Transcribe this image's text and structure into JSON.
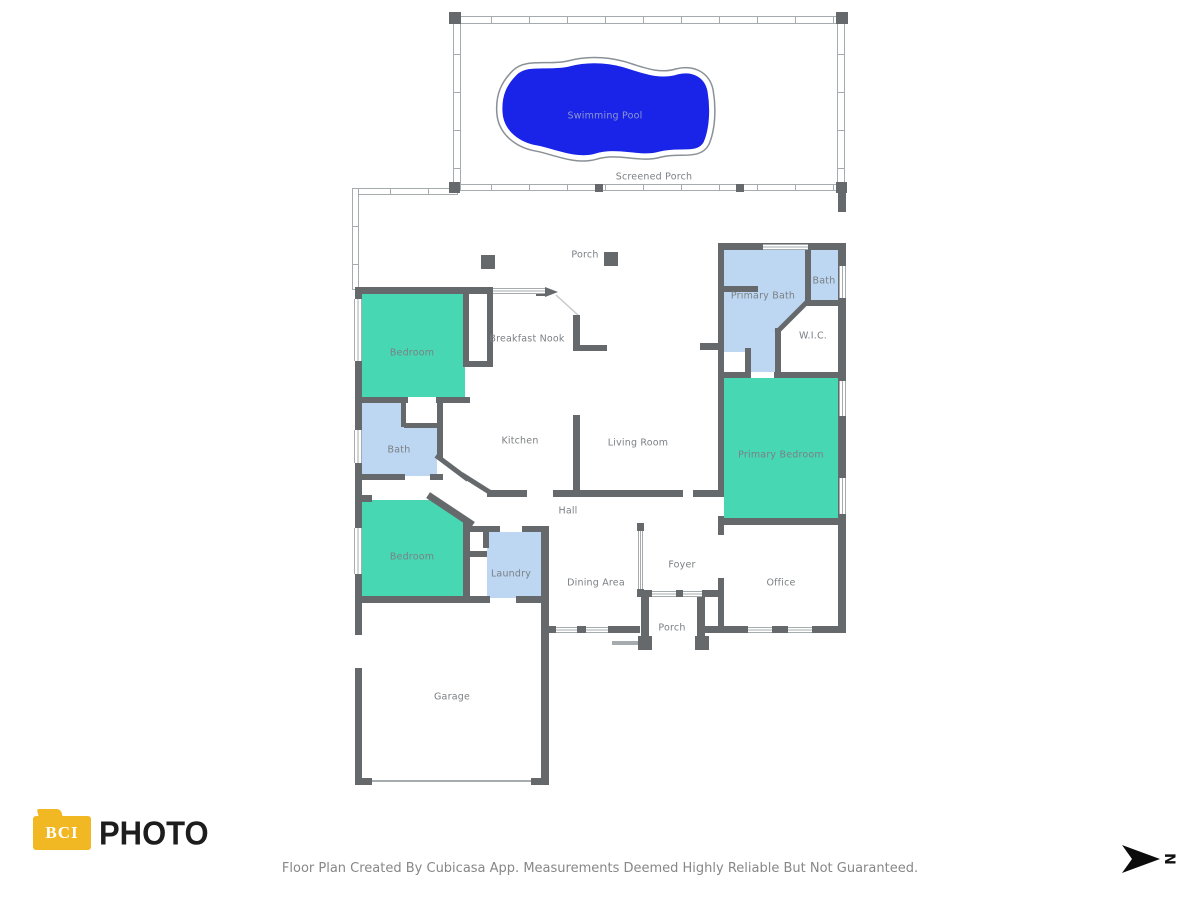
{
  "labels": {
    "swimming_pool": "Swimming Pool",
    "screened_porch": "Screened Porch",
    "porch_top": "Porch",
    "breakfast_nook": "Breakfast Nook",
    "bedroom1": "Bedroom",
    "kitchen": "Kitchen",
    "living_room": "Living Room",
    "primary_bath": "Primary Bath",
    "bath2": "Bath",
    "wic": "W.I.C.",
    "primary_bedroom": "Primary Bedroom",
    "bath1": "Bath",
    "hall": "Hall",
    "bedroom2": "Bedroom",
    "laundry": "Laundry",
    "dining": "Dining Area",
    "foyer": "Foyer",
    "office": "Office",
    "porch_bottom": "Porch",
    "garage": "Garage"
  },
  "branding": {
    "logo_text_primary": "BCI",
    "logo_text_secondary": "PHOTO"
  },
  "footer": {
    "caption": "Floor Plan Created By Cubicasa App. Measurements Deemed Highly Reliable But Not Guaranteed."
  },
  "compass": {
    "north_label": "N"
  },
  "colors": {
    "wall": "#66696c",
    "room_teal": "#47d7b3",
    "room_blue": "#bdd7f2",
    "pool_blue": "#1a23e8",
    "label": "#7b8084",
    "pool_label": "#8d98cf",
    "logo_yellow": "#f2b824",
    "rail": "#a6abae"
  }
}
